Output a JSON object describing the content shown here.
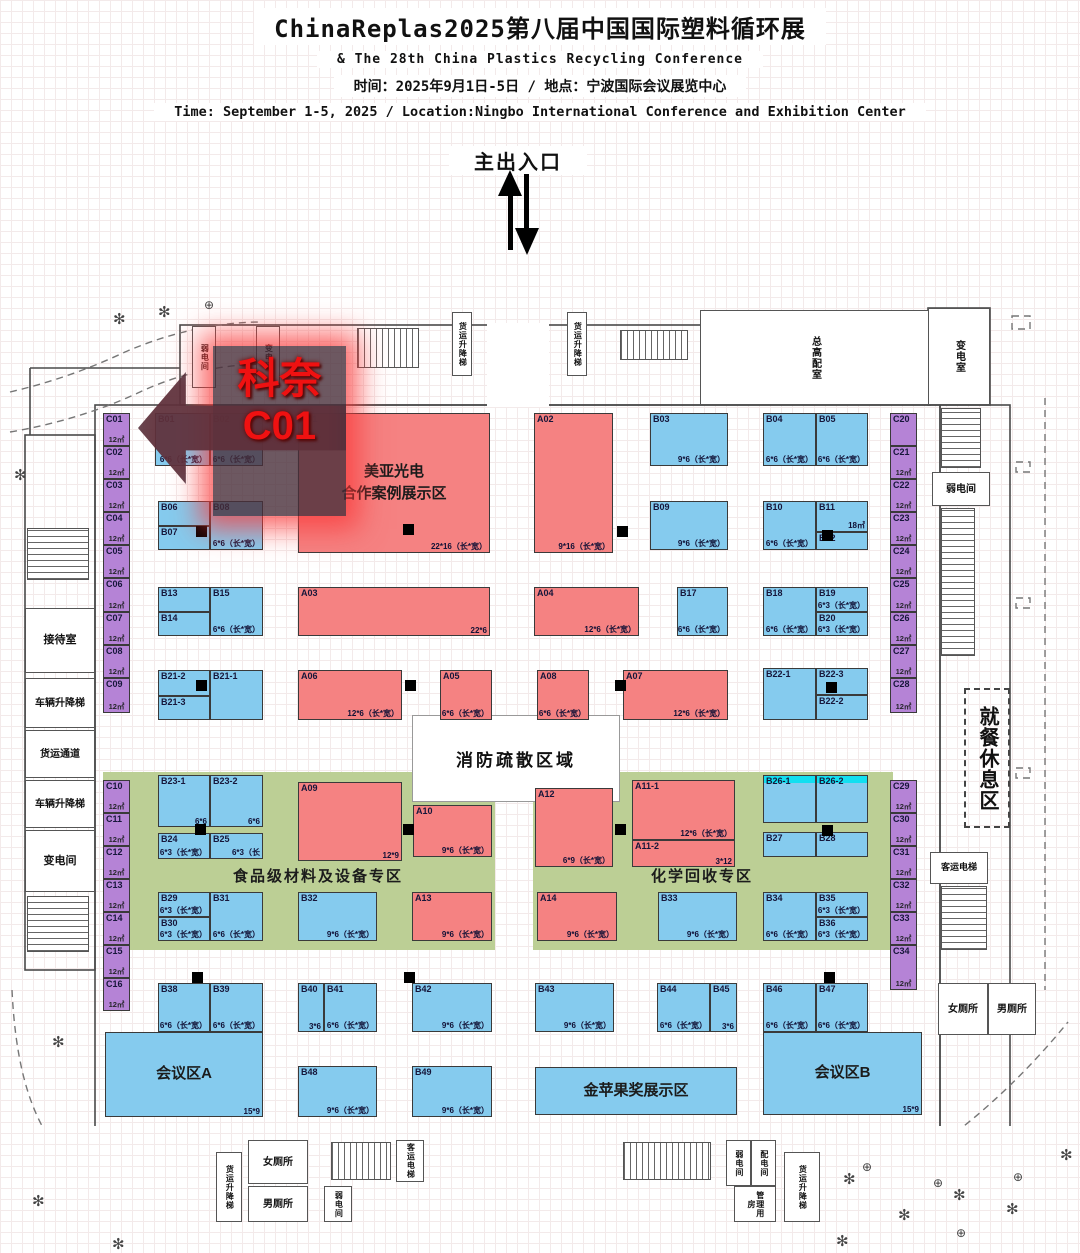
{
  "header": {
    "title": "ChinaReplas2025第八届中国国际塑料循环展",
    "subtitle": "& The 28th China Plastics Recycling Conference",
    "line_cn": "时间：2025年9月1日-5日 / 地点：宁波国际会议展览中心",
    "line_en": "Time: September 1-5, 2025 / Location:Ningbo International Conference and Exhibition Center"
  },
  "entrance_label": "主出入口",
  "promo": {
    "line1": "科奈",
    "line2": "C01"
  },
  "fire_zone_label": "消防疏散区域",
  "colors": {
    "booth_a_red": "#f58282",
    "booth_b_blue": "#85cbee",
    "booth_c_purple": "#b583d6",
    "zone_green": "#bccf95",
    "cyan_strip": "#12dff0",
    "promo_red": "#ef1111"
  },
  "icons": {
    "tree": "✻",
    "lamp": "⊕"
  },
  "zones": [
    {
      "label": "食品级材料及设备专区",
      "x": 103,
      "y": 632,
      "w": 392,
      "h": 178,
      "lx": 130,
      "ly": 93
    },
    {
      "label": "化学回收专区",
      "x": 533,
      "y": 632,
      "w": 360,
      "h": 178,
      "lx": 118,
      "ly": 93
    }
  ],
  "areas": [
    {
      "id": "A01",
      "t": "r",
      "x": 298,
      "y": 273,
      "w": 192,
      "h": 140,
      "center": "美亚光电\n合作案例展示区",
      "sz": "22*16（长*宽）"
    },
    {
      "id": "会议区A",
      "t": "b",
      "x": 105,
      "y": 892,
      "w": 158,
      "h": 85,
      "center": "会议区A",
      "sz": "15*9"
    },
    {
      "id": "金苹果奖展示区",
      "t": "b",
      "x": 535,
      "y": 927,
      "w": 202,
      "h": 48,
      "center": "金苹果奖展示区"
    },
    {
      "id": "会议区B",
      "t": "b",
      "x": 763,
      "y": 892,
      "w": 159,
      "h": 83,
      "center": "会议区B",
      "sz": "15*9"
    }
  ],
  "booths": [
    {
      "id": "B01",
      "t": "b",
      "x": 155,
      "y": 273,
      "w": 55,
      "h": 53,
      "sz": "6*6（长*宽）"
    },
    {
      "id": "B02",
      "t": "b",
      "x": 210,
      "y": 273,
      "w": 53,
      "h": 53,
      "sz": "6*6（长*宽）"
    },
    {
      "id": "B03",
      "t": "b",
      "x": 650,
      "y": 273,
      "w": 78,
      "h": 53,
      "sz": "9*6（长*宽）"
    },
    {
      "id": "B04",
      "t": "b",
      "x": 763,
      "y": 273,
      "w": 53,
      "h": 53,
      "sz": "6*6（长*宽）"
    },
    {
      "id": "B05",
      "t": "b",
      "x": 816,
      "y": 273,
      "w": 52,
      "h": 53,
      "sz": "6*6（长*宽）"
    },
    {
      "id": "A02",
      "t": "r",
      "x": 534,
      "y": 273,
      "w": 79,
      "h": 140,
      "sz": "9*16（长*宽）"
    },
    {
      "id": "B06",
      "t": "b",
      "x": 158,
      "y": 361,
      "w": 52,
      "h": 25
    },
    {
      "id": "B07",
      "t": "b",
      "x": 158,
      "y": 386,
      "w": 52,
      "h": 24
    },
    {
      "id": "B08",
      "t": "b",
      "x": 210,
      "y": 361,
      "w": 53,
      "h": 49,
      "sz": "6*6（长*宽）"
    },
    {
      "id": "B09",
      "t": "b",
      "x": 650,
      "y": 361,
      "w": 78,
      "h": 49,
      "sz": "9*6（长*宽）"
    },
    {
      "id": "B10",
      "t": "b",
      "x": 763,
      "y": 361,
      "w": 53,
      "h": 49,
      "sz": "6*6（长*宽）"
    },
    {
      "id": "B11",
      "t": "b",
      "x": 816,
      "y": 361,
      "w": 52,
      "h": 31,
      "sz": "18㎡"
    },
    {
      "id": "B12",
      "t": "b",
      "x": 816,
      "y": 392,
      "w": 52,
      "h": 18
    },
    {
      "id": "B13",
      "t": "b",
      "x": 158,
      "y": 447,
      "w": 52,
      "h": 25
    },
    {
      "id": "B14",
      "t": "b",
      "x": 158,
      "y": 472,
      "w": 52,
      "h": 24
    },
    {
      "id": "B15",
      "t": "b",
      "x": 210,
      "y": 447,
      "w": 53,
      "h": 49,
      "sz": "6*6（长*宽）"
    },
    {
      "id": "A03",
      "t": "r",
      "x": 298,
      "y": 447,
      "w": 192,
      "h": 49,
      "sz": "22*6"
    },
    {
      "id": "A04",
      "t": "r",
      "x": 534,
      "y": 447,
      "w": 105,
      "h": 49,
      "sz": "12*6（长*宽）"
    },
    {
      "id": "B17",
      "t": "b",
      "x": 677,
      "y": 447,
      "w": 51,
      "h": 49,
      "sz": "6*6（长*宽）"
    },
    {
      "id": "B18",
      "t": "b",
      "x": 763,
      "y": 447,
      "w": 53,
      "h": 49,
      "sz": "6*6（长*宽）"
    },
    {
      "id": "B19",
      "t": "b",
      "x": 816,
      "y": 447,
      "w": 52,
      "h": 25,
      "sz": "6*3（长*宽）"
    },
    {
      "id": "B20",
      "t": "b",
      "x": 816,
      "y": 472,
      "w": 52,
      "h": 24,
      "sz": "6*3（长*宽）"
    },
    {
      "id": "B21-2",
      "t": "b",
      "x": 158,
      "y": 530,
      "w": 52,
      "h": 26
    },
    {
      "id": "B21-3",
      "t": "b",
      "x": 158,
      "y": 556,
      "w": 52,
      "h": 24
    },
    {
      "id": "B21-1",
      "t": "b",
      "x": 210,
      "y": 530,
      "w": 53,
      "h": 50
    },
    {
      "id": "A06",
      "t": "r",
      "x": 298,
      "y": 530,
      "w": 104,
      "h": 50,
      "sz": "12*6（长*宽）"
    },
    {
      "id": "A05",
      "t": "r",
      "x": 440,
      "y": 530,
      "w": 52,
      "h": 50,
      "sz": "6*6（长*宽）"
    },
    {
      "id": "A08",
      "t": "r",
      "x": 537,
      "y": 530,
      "w": 52,
      "h": 50,
      "sz": "6*6（长*宽）"
    },
    {
      "id": "A07",
      "t": "r",
      "x": 623,
      "y": 530,
      "w": 105,
      "h": 50,
      "sz": "12*6（长*宽）"
    },
    {
      "id": "B22-1",
      "t": "b",
      "x": 763,
      "y": 528,
      "w": 53,
      "h": 52
    },
    {
      "id": "B22-3",
      "t": "b",
      "x": 816,
      "y": 528,
      "w": 52,
      "h": 27
    },
    {
      "id": "B22-2",
      "t": "b",
      "x": 816,
      "y": 555,
      "w": 52,
      "h": 25
    },
    {
      "id": "B23-1",
      "t": "b",
      "x": 158,
      "y": 635,
      "w": 52,
      "h": 52,
      "sz": "6*6"
    },
    {
      "id": "B23-2",
      "t": "b",
      "x": 210,
      "y": 635,
      "w": 53,
      "h": 52,
      "sz": "6*6"
    },
    {
      "id": "B24",
      "t": "b",
      "x": 158,
      "y": 693,
      "w": 52,
      "h": 26,
      "sz": "6*3（长*宽）"
    },
    {
      "id": "B25",
      "t": "b",
      "x": 210,
      "y": 693,
      "w": 53,
      "h": 26,
      "sz": "6*3（长"
    },
    {
      "id": "A09",
      "t": "r",
      "x": 298,
      "y": 642,
      "w": 104,
      "h": 79,
      "sz": "12*9"
    },
    {
      "id": "A10",
      "t": "r",
      "x": 413,
      "y": 665,
      "w": 79,
      "h": 52,
      "sz": "9*6（长*宽）"
    },
    {
      "id": "A12",
      "t": "r",
      "x": 535,
      "y": 648,
      "w": 78,
      "h": 79,
      "sz": "6*9（长*宽）"
    },
    {
      "id": "A11-1",
      "t": "r",
      "x": 632,
      "y": 640,
      "w": 103,
      "h": 60,
      "sz": "12*6（长*宽）"
    },
    {
      "id": "A11-2",
      "t": "r",
      "x": 632,
      "y": 700,
      "w": 103,
      "h": 27,
      "sz": "3*12"
    },
    {
      "id": "B26-1",
      "t": "b",
      "x": 763,
      "y": 635,
      "w": 53,
      "h": 48,
      "cy": 1
    },
    {
      "id": "B26-2",
      "t": "b",
      "x": 816,
      "y": 635,
      "w": 52,
      "h": 48,
      "cy": 1
    },
    {
      "id": "B27",
      "t": "b",
      "x": 763,
      "y": 692,
      "w": 53,
      "h": 25
    },
    {
      "id": "B28",
      "t": "b",
      "x": 816,
      "y": 692,
      "w": 52,
      "h": 25
    },
    {
      "id": "B29",
      "t": "b",
      "x": 158,
      "y": 752,
      "w": 52,
      "h": 25,
      "sz": "6*3（长*宽）"
    },
    {
      "id": "B30",
      "t": "b",
      "x": 158,
      "y": 777,
      "w": 52,
      "h": 24,
      "sz": "6*3（长*宽）"
    },
    {
      "id": "B31",
      "t": "b",
      "x": 210,
      "y": 752,
      "w": 53,
      "h": 49,
      "sz": "6*6（长*宽）"
    },
    {
      "id": "B32",
      "t": "b",
      "x": 298,
      "y": 752,
      "w": 79,
      "h": 49,
      "sz": "9*6（长*宽）"
    },
    {
      "id": "A13",
      "t": "r",
      "x": 412,
      "y": 752,
      "w": 80,
      "h": 49,
      "sz": "9*6（长*宽）"
    },
    {
      "id": "A14",
      "t": "r",
      "x": 537,
      "y": 752,
      "w": 80,
      "h": 49,
      "sz": "9*6（长*宽）"
    },
    {
      "id": "B33",
      "t": "b",
      "x": 658,
      "y": 752,
      "w": 79,
      "h": 49,
      "sz": "9*6（长*宽）"
    },
    {
      "id": "B34",
      "t": "b",
      "x": 763,
      "y": 752,
      "w": 53,
      "h": 49,
      "sz": "6*6（长*宽）"
    },
    {
      "id": "B35",
      "t": "b",
      "x": 816,
      "y": 752,
      "w": 52,
      "h": 25,
      "sz": "6*3（长*宽）"
    },
    {
      "id": "B36",
      "t": "b",
      "x": 816,
      "y": 777,
      "w": 52,
      "h": 24,
      "sz": "6*3（长*宽）"
    },
    {
      "id": "B38",
      "t": "b",
      "x": 158,
      "y": 843,
      "w": 52,
      "h": 49,
      "sz": "6*6（长*宽）"
    },
    {
      "id": "B39",
      "t": "b",
      "x": 210,
      "y": 843,
      "w": 53,
      "h": 49,
      "sz": "6*6（长*宽）"
    },
    {
      "id": "B40",
      "t": "b",
      "x": 298,
      "y": 843,
      "w": 26,
      "h": 49,
      "sz": "3*6"
    },
    {
      "id": "B41",
      "t": "b",
      "x": 324,
      "y": 843,
      "w": 53,
      "h": 49,
      "sz": "6*6（长*宽）"
    },
    {
      "id": "B42",
      "t": "b",
      "x": 412,
      "y": 843,
      "w": 80,
      "h": 49,
      "sz": "9*6（长*宽）"
    },
    {
      "id": "B43",
      "t": "b",
      "x": 535,
      "y": 843,
      "w": 79,
      "h": 49,
      "sz": "9*6（长*宽）"
    },
    {
      "id": "B44",
      "t": "b",
      "x": 657,
      "y": 843,
      "w": 53,
      "h": 49,
      "sz": "6*6（长*宽）"
    },
    {
      "id": "B45",
      "t": "b",
      "x": 710,
      "y": 843,
      "w": 27,
      "h": 49,
      "sz": "3*6"
    },
    {
      "id": "B46",
      "t": "b",
      "x": 763,
      "y": 843,
      "w": 53,
      "h": 49,
      "sz": "6*6（长*宽）"
    },
    {
      "id": "B47",
      "t": "b",
      "x": 816,
      "y": 843,
      "w": 52,
      "h": 49,
      "sz": "6*6（长*宽）"
    },
    {
      "id": "B48",
      "t": "b",
      "x": 298,
      "y": 926,
      "w": 79,
      "h": 51,
      "sz": "9*6（长*宽）"
    },
    {
      "id": "B49",
      "t": "b",
      "x": 412,
      "y": 926,
      "w": 80,
      "h": 51,
      "sz": "9*6（长*宽）"
    },
    {
      "id": "C01",
      "t": "p",
      "x": 103,
      "y": 273,
      "w": 27,
      "h": 33,
      "area": "12㎡"
    },
    {
      "id": "C02",
      "t": "p",
      "x": 103,
      "y": 306,
      "w": 27,
      "h": 33,
      "area": "12㎡"
    },
    {
      "id": "C03",
      "t": "p",
      "x": 103,
      "y": 339,
      "w": 27,
      "h": 33,
      "area": "12㎡"
    },
    {
      "id": "C04",
      "t": "p",
      "x": 103,
      "y": 372,
      "w": 27,
      "h": 33,
      "area": "12㎡"
    },
    {
      "id": "C05",
      "t": "p",
      "x": 103,
      "y": 405,
      "w": 27,
      "h": 33,
      "area": "12㎡"
    },
    {
      "id": "C06",
      "t": "p",
      "x": 103,
      "y": 438,
      "w": 27,
      "h": 34,
      "area": "12㎡"
    },
    {
      "id": "C07",
      "t": "p",
      "x": 103,
      "y": 472,
      "w": 27,
      "h": 33,
      "area": "12㎡"
    },
    {
      "id": "C08",
      "t": "p",
      "x": 103,
      "y": 505,
      "w": 27,
      "h": 33,
      "area": "12㎡"
    },
    {
      "id": "C09",
      "t": "p",
      "x": 103,
      "y": 538,
      "w": 27,
      "h": 35,
      "area": "12㎡"
    },
    {
      "id": "C10",
      "t": "p",
      "x": 103,
      "y": 640,
      "w": 27,
      "h": 33,
      "area": "12㎡"
    },
    {
      "id": "C11",
      "t": "p",
      "x": 103,
      "y": 673,
      "w": 27,
      "h": 33,
      "area": "12㎡"
    },
    {
      "id": "C12",
      "t": "p",
      "x": 103,
      "y": 706,
      "w": 27,
      "h": 33,
      "area": "12㎡"
    },
    {
      "id": "C13",
      "t": "p",
      "x": 103,
      "y": 739,
      "w": 27,
      "h": 33,
      "area": "12㎡"
    },
    {
      "id": "C14",
      "t": "p",
      "x": 103,
      "y": 772,
      "w": 27,
      "h": 33,
      "area": "12㎡"
    },
    {
      "id": "C15",
      "t": "p",
      "x": 103,
      "y": 805,
      "w": 27,
      "h": 33,
      "area": "12㎡"
    },
    {
      "id": "C16",
      "t": "p",
      "x": 103,
      "y": 838,
      "w": 27,
      "h": 33,
      "area": "12㎡"
    },
    {
      "id": "C20",
      "t": "p",
      "x": 890,
      "y": 273,
      "w": 27,
      "h": 33
    },
    {
      "id": "C21",
      "t": "p",
      "x": 890,
      "y": 306,
      "w": 27,
      "h": 33,
      "area": "12㎡"
    },
    {
      "id": "C22",
      "t": "p",
      "x": 890,
      "y": 339,
      "w": 27,
      "h": 33,
      "area": "12㎡"
    },
    {
      "id": "C23",
      "t": "p",
      "x": 890,
      "y": 372,
      "w": 27,
      "h": 33,
      "area": "12㎡"
    },
    {
      "id": "C24",
      "t": "p",
      "x": 890,
      "y": 405,
      "w": 27,
      "h": 33,
      "area": "12㎡"
    },
    {
      "id": "C25",
      "t": "p",
      "x": 890,
      "y": 438,
      "w": 27,
      "h": 34,
      "area": "12㎡"
    },
    {
      "id": "C26",
      "t": "p",
      "x": 890,
      "y": 472,
      "w": 27,
      "h": 33,
      "area": "12㎡"
    },
    {
      "id": "C27",
      "t": "p",
      "x": 890,
      "y": 505,
      "w": 27,
      "h": 33,
      "area": "12㎡"
    },
    {
      "id": "C28",
      "t": "p",
      "x": 890,
      "y": 538,
      "w": 27,
      "h": 35,
      "area": "12㎡"
    },
    {
      "id": "C29",
      "t": "p",
      "x": 890,
      "y": 640,
      "w": 27,
      "h": 33,
      "area": "12㎡"
    },
    {
      "id": "C30",
      "t": "p",
      "x": 890,
      "y": 673,
      "w": 27,
      "h": 33,
      "area": "12㎡"
    },
    {
      "id": "C31",
      "t": "p",
      "x": 890,
      "y": 706,
      "w": 27,
      "h": 33,
      "area": "12㎡"
    },
    {
      "id": "C32",
      "t": "p",
      "x": 890,
      "y": 739,
      "w": 27,
      "h": 33,
      "area": "12㎡"
    },
    {
      "id": "C33",
      "t": "p",
      "x": 890,
      "y": 772,
      "w": 27,
      "h": 33,
      "area": "12㎡"
    },
    {
      "id": "C34",
      "t": "p",
      "x": 890,
      "y": 805,
      "w": 27,
      "h": 45,
      "area": "12㎡"
    }
  ],
  "fire_zone": {
    "x": 412,
    "y": 575,
    "w": 206,
    "h": 85
  },
  "rooms": [
    {
      "label": "弱电间",
      "x": 192,
      "y": 186,
      "w": 24,
      "h": 62,
      "v": 1,
      "fs": 8
    },
    {
      "label": "变电间",
      "x": 256,
      "y": 186,
      "w": 24,
      "h": 62,
      "v": 1,
      "fs": 8
    },
    {
      "label": "货运升降梯",
      "x": 452,
      "y": 172,
      "w": 20,
      "h": 64,
      "v": 1,
      "fs": 8
    },
    {
      "label": "货运升降梯",
      "x": 567,
      "y": 172,
      "w": 20,
      "h": 64,
      "v": 1,
      "fs": 8
    },
    {
      "label": "总高配室",
      "x": 700,
      "y": 170,
      "w": 230,
      "h": 95,
      "v": 1,
      "fs": 10
    },
    {
      "label": "变电室",
      "x": 928,
      "y": 168,
      "w": 62,
      "h": 97,
      "v": 1,
      "fs": 10
    },
    {
      "label": "接待室",
      "x": 25,
      "y": 468,
      "w": 70,
      "h": 65,
      "fs": 11
    },
    {
      "label": "车辆升降梯",
      "x": 25,
      "y": 538,
      "w": 70,
      "h": 50,
      "fs": 10
    },
    {
      "label": "货运通道",
      "x": 25,
      "y": 590,
      "w": 70,
      "h": 48,
      "fs": 10
    },
    {
      "label": "车辆升降梯",
      "x": 25,
      "y": 640,
      "w": 70,
      "h": 48,
      "fs": 10
    },
    {
      "label": "变电间",
      "x": 25,
      "y": 690,
      "w": 70,
      "h": 62,
      "fs": 11
    },
    {
      "label": "弱电间",
      "x": 932,
      "y": 332,
      "w": 58,
      "h": 34,
      "fs": 10
    },
    {
      "label": "就餐休息区",
      "x": 964,
      "y": 548,
      "w": 46,
      "h": 140,
      "v": 1,
      "d": 1,
      "fs": 20
    },
    {
      "label": "客运电梯",
      "x": 930,
      "y": 712,
      "w": 58,
      "h": 32,
      "fs": 9
    },
    {
      "label": "女厕所",
      "x": 938,
      "y": 843,
      "w": 50,
      "h": 52,
      "fs": 10
    },
    {
      "label": "男厕所",
      "x": 988,
      "y": 843,
      "w": 48,
      "h": 52,
      "fs": 10
    },
    {
      "label": "货运升降梯",
      "x": 216,
      "y": 1012,
      "w": 26,
      "h": 70,
      "v": 1,
      "fs": 8
    },
    {
      "label": "女厕所",
      "x": 248,
      "y": 1000,
      "w": 60,
      "h": 44,
      "fs": 10
    },
    {
      "label": "男厕所",
      "x": 248,
      "y": 1046,
      "w": 60,
      "h": 36,
      "fs": 10
    },
    {
      "label": "弱电间",
      "x": 324,
      "y": 1046,
      "w": 28,
      "h": 36,
      "v": 1,
      "fs": 8
    },
    {
      "label": "客运电梯",
      "x": 396,
      "y": 1000,
      "w": 28,
      "h": 42,
      "v": 1,
      "fs": 8
    },
    {
      "label": "弱电间",
      "x": 726,
      "y": 1000,
      "w": 25,
      "h": 46,
      "v": 1,
      "fs": 8
    },
    {
      "label": "配电间",
      "x": 751,
      "y": 1000,
      "w": 25,
      "h": 46,
      "v": 1,
      "fs": 8
    },
    {
      "label": "管理用房",
      "x": 734,
      "y": 1046,
      "w": 42,
      "h": 36,
      "v": 1,
      "fs": 8
    },
    {
      "label": "货运升降梯",
      "x": 784,
      "y": 1012,
      "w": 36,
      "h": 70,
      "v": 1,
      "fs": 8
    }
  ],
  "stairs": [
    {
      "x": 357,
      "y": 188,
      "w": 62,
      "h": 40,
      "v": 1
    },
    {
      "x": 620,
      "y": 190,
      "w": 68,
      "h": 30,
      "v": 1
    },
    {
      "x": 27,
      "y": 388,
      "w": 62,
      "h": 52,
      "v": 0
    },
    {
      "x": 27,
      "y": 756,
      "w": 62,
      "h": 56,
      "v": 0
    },
    {
      "x": 941,
      "y": 268,
      "w": 40,
      "h": 60,
      "v": 0
    },
    {
      "x": 941,
      "y": 368,
      "w": 34,
      "h": 148,
      "v": 0
    },
    {
      "x": 941,
      "y": 746,
      "w": 46,
      "h": 64,
      "v": 0
    },
    {
      "x": 331,
      "y": 1002,
      "w": 60,
      "h": 38,
      "v": 1
    },
    {
      "x": 623,
      "y": 1002,
      "w": 88,
      "h": 38,
      "v": 1
    }
  ],
  "pillars": [
    [
      196,
      386
    ],
    [
      403,
      384
    ],
    [
      617,
      386
    ],
    [
      822,
      390
    ],
    [
      196,
      540
    ],
    [
      405,
      540
    ],
    [
      615,
      540
    ],
    [
      826,
      542
    ],
    [
      195,
      684
    ],
    [
      403,
      684
    ],
    [
      615,
      684
    ],
    [
      822,
      685
    ],
    [
      192,
      832
    ],
    [
      404,
      832
    ],
    [
      824,
      832
    ]
  ],
  "trees": [
    [
      113,
      170
    ],
    [
      158,
      163
    ],
    [
      14,
      326
    ],
    [
      52,
      893
    ],
    [
      32,
      1052
    ],
    [
      112,
      1095
    ],
    [
      843,
      1030
    ],
    [
      898,
      1066
    ],
    [
      953,
      1046
    ],
    [
      1006,
      1060
    ],
    [
      1060,
      1006
    ],
    [
      836,
      1092
    ]
  ],
  "lamps": [
    [
      204,
      158
    ],
    [
      862,
      1020
    ],
    [
      933,
      1036
    ],
    [
      1013,
      1030
    ],
    [
      956,
      1086
    ]
  ]
}
